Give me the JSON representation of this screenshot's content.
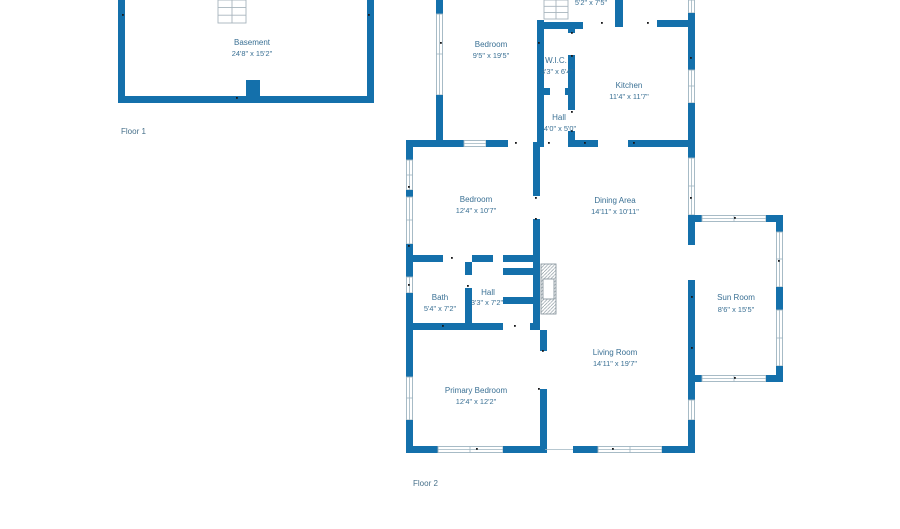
{
  "palette": {
    "wall_color": "#1470ab",
    "room_label_color": "#3a7094",
    "floor_label_color": "#47708a",
    "window_symbol_color": "#9eb4c0"
  },
  "floor1": {
    "label": "Floor 1",
    "rooms": {
      "basement": {
        "name": "Basement",
        "dims": "24'8\" x 15'2\""
      }
    }
  },
  "floor2": {
    "label": "Floor 2",
    "rooms": {
      "top_partial": {
        "name": "",
        "dims": "5'2\" x 7'5\""
      },
      "bedroom_upper": {
        "name": "Bedroom",
        "dims": "9'5\" x 19'5\""
      },
      "wic": {
        "name": "W.I.C.",
        "dims": "3'3\" x 6'4\""
      },
      "kitchen": {
        "name": "Kitchen",
        "dims": "11'4\" x 11'7\""
      },
      "hall_upper": {
        "name": "Hall",
        "dims": "4'0\" x 5'0\""
      },
      "bedroom_mid": {
        "name": "Bedroom",
        "dims": "12'4\" x 10'7\""
      },
      "dining_area": {
        "name": "Dining Area",
        "dims": "14'11\" x 10'11\""
      },
      "bath": {
        "name": "Bath",
        "dims": "5'4\" x 7'2\""
      },
      "hall_lower": {
        "name": "Hall",
        "dims": "3'3\" x 7'2\""
      },
      "sun_room": {
        "name": "Sun Room",
        "dims": "8'6\" x 15'5\""
      },
      "living_room": {
        "name": "Living Room",
        "dims": "14'11\" x 19'7\""
      },
      "primary_bedroom": {
        "name": "Primary Bedroom",
        "dims": "12'4\" x 12'2\""
      }
    }
  }
}
